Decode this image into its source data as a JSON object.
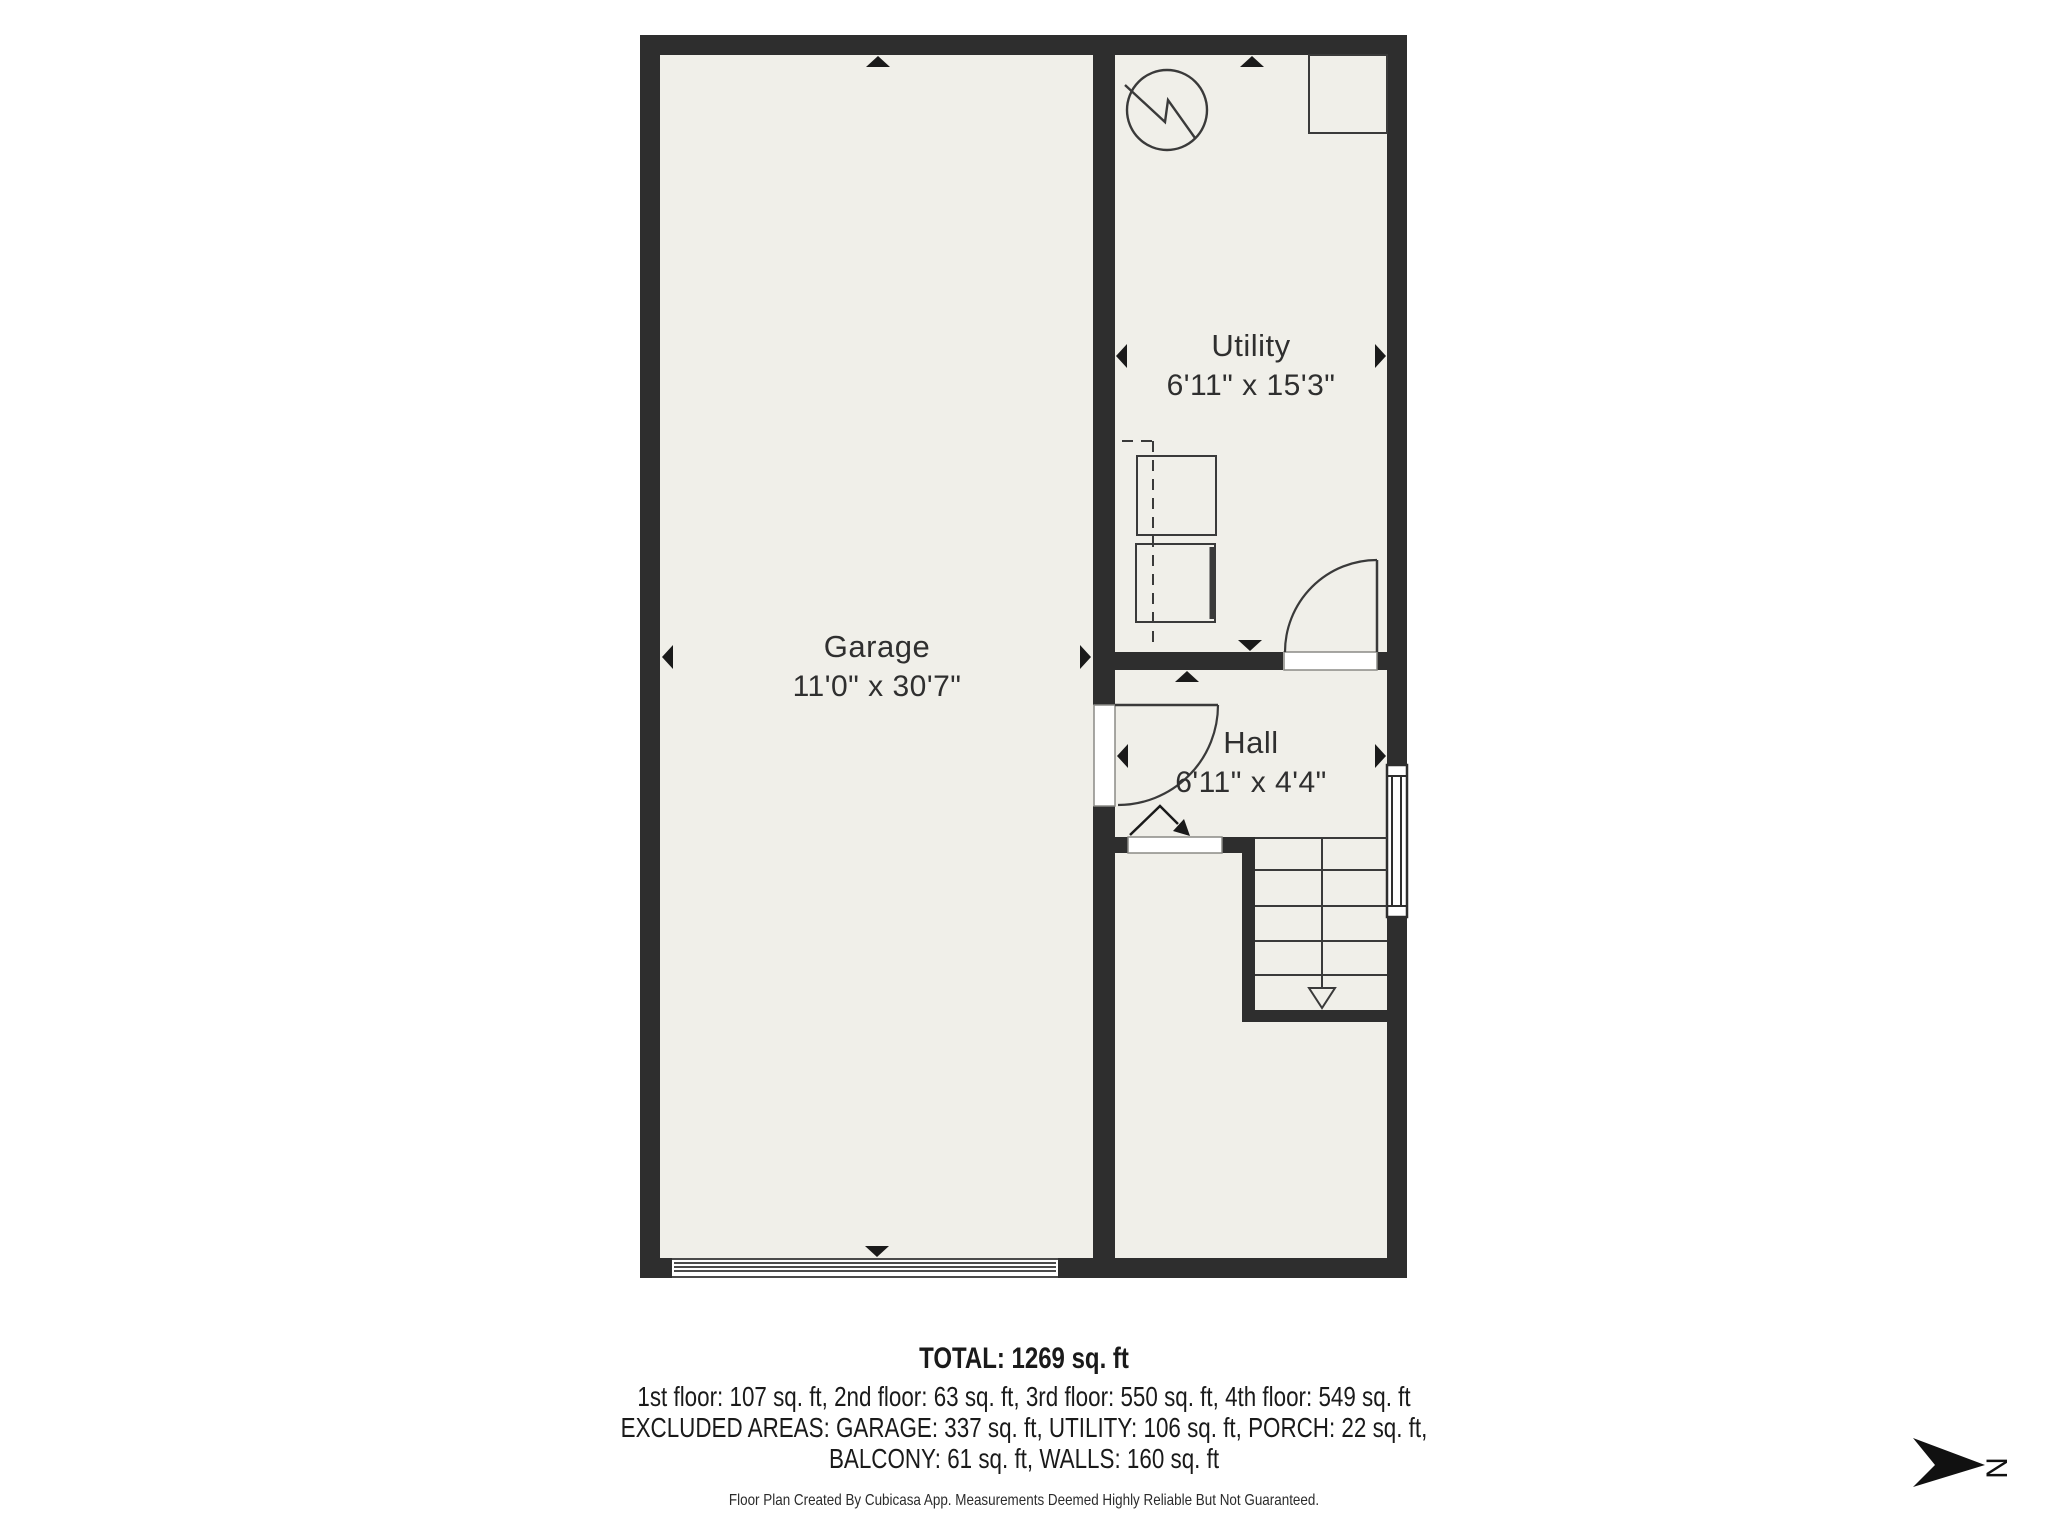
{
  "rooms": {
    "garage": {
      "name": "Garage",
      "dims": "11'0\" x 30'7\""
    },
    "utility": {
      "name": "Utility",
      "dims": "6'11\" x 15'3\""
    },
    "hall": {
      "name": "Hall",
      "dims": "6'11\" x 4'4\""
    }
  },
  "summary": {
    "total": "TOTAL: 1269 sq. ft",
    "floors": "1st floor: 107 sq. ft, 2nd floor: 63 sq. ft, 3rd floor: 550 sq. ft, 4th floor: 549 sq. ft",
    "excluded_1": "EXCLUDED AREAS: GARAGE: 337 sq. ft, UTILITY: 106 sq. ft, PORCH: 22 sq. ft,",
    "excluded_2": "BALCONY: 61 sq. ft, WALLS: 160 sq. ft"
  },
  "footer": {
    "disclaimer": "Floor Plan Created By Cubicasa App. Measurements Deemed Highly Reliable But Not Guaranteed."
  },
  "compass": {
    "label": "N"
  },
  "colors": {
    "background": "#ffffff",
    "wall": "#2e2e2e",
    "floor": "#f0efe9",
    "line": "#3a3a3a",
    "arrow": "#111111"
  }
}
